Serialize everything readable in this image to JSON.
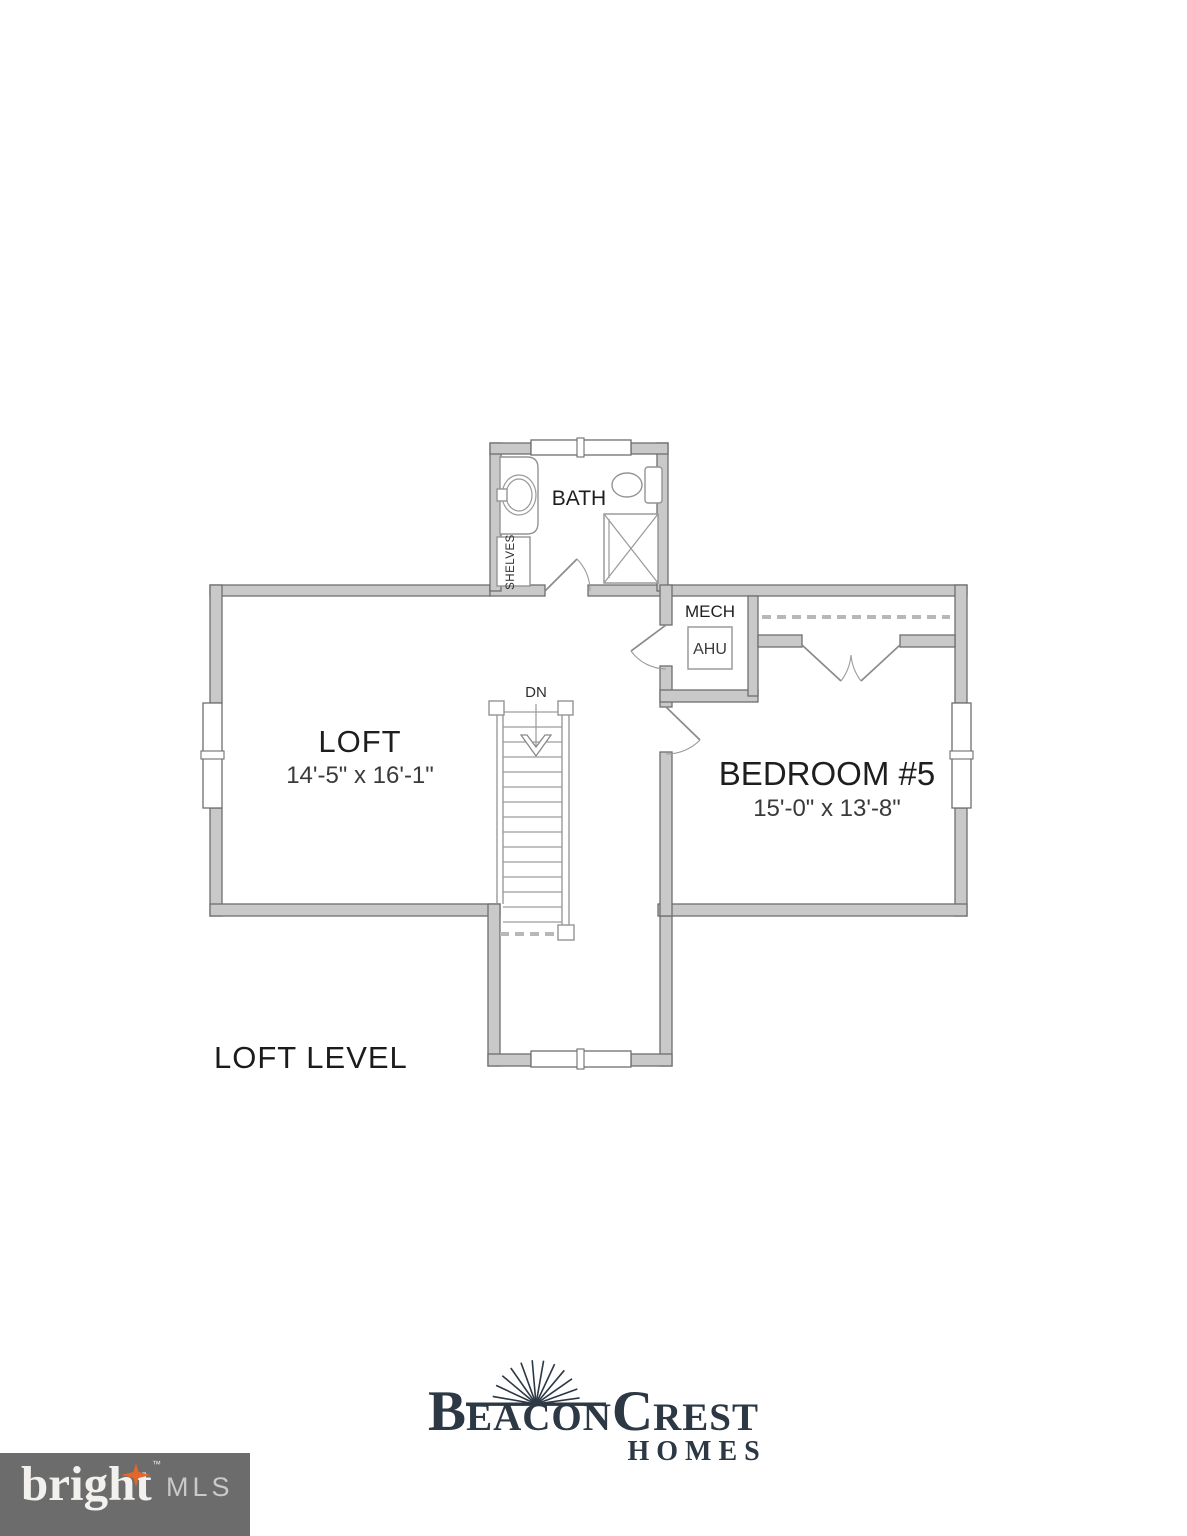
{
  "plan": {
    "level_title": "LOFT LEVEL",
    "rooms": {
      "bath": {
        "label": "BATH"
      },
      "loft": {
        "label": "LOFT",
        "dims": "14'-5\" x 16'-1\""
      },
      "bedroom5": {
        "label": "BEDROOM #5",
        "dims": "15'-0\" x 13'-8\""
      },
      "mech": {
        "label": "MECH",
        "unit_label": "AHU"
      },
      "shelves_label": "SHELVES"
    },
    "stairs": {
      "direction_label": "DN"
    }
  },
  "branding": {
    "builder": {
      "b": "B",
      "eacon": "EACON",
      "c": "C",
      "rest": "REST",
      "homes": "HOMES",
      "color": "#2c3844"
    },
    "mls": {
      "name": "bright",
      "tm": "™",
      "suffix": "MLS",
      "bg_color": "#6c6c6c",
      "star_color": "#e2672a"
    }
  },
  "colors": {
    "wall_fill": "#c9c9c9",
    "wall_stroke": "#6e6e6e",
    "label_color": "#1e1e1e"
  }
}
